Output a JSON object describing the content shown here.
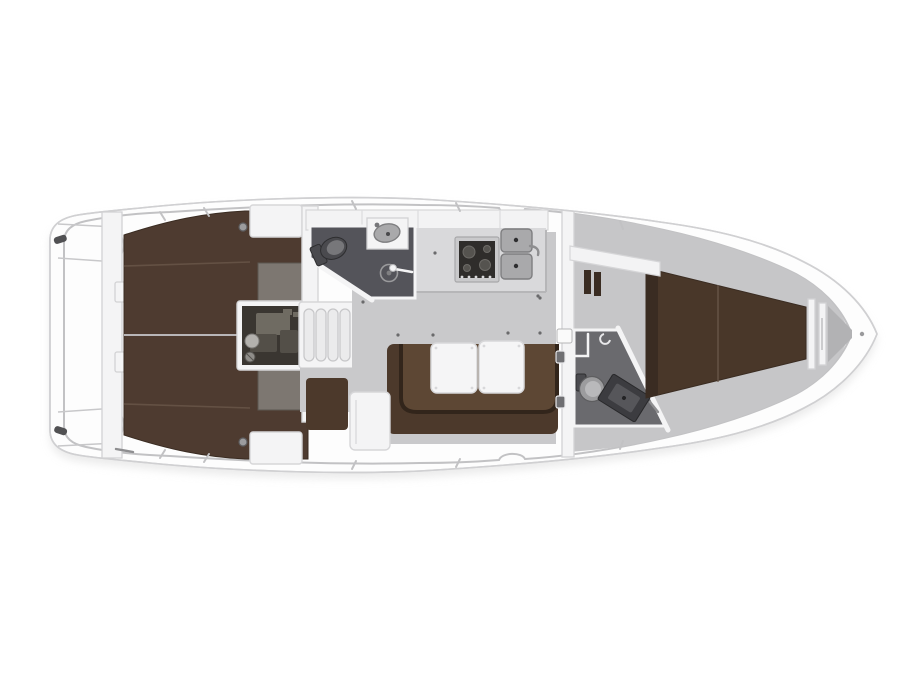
{
  "diagram": {
    "type": "boat-floor-plan",
    "subject": "sailing-yacht-interior-top-view",
    "orientation": "bow-right-stern-left",
    "background": "#ffffff"
  },
  "parts": {
    "stern_deck": "aft deck and transom lockers",
    "aft_bulkhead": "aft bulkhead panel",
    "port_aft_cabin": "port aft double berth",
    "starboard_aft_cabin": "starboard aft double berth",
    "engine_compartment": "engine compartment",
    "companionway_steps": "companionway steps",
    "aft_head": "aft bathroom with toilet, sink and shower",
    "galley": "galley with stove and double sink",
    "salon": "salon with U-settee and folding table",
    "nav_seat": "seat beside companionway",
    "forward_bulkhead": "forward cabin bulkhead with door",
    "forward_head": "forward bathroom with toilet and vanity",
    "forward_cabin": "forward V-berth cabin",
    "anchor_locker": "bow anchor locker",
    "bow": "bow tip"
  },
  "colors": {
    "hull": "#fdfdfd",
    "hullStroke": "#d0d0d2",
    "innerLine": "#c2c2c4",
    "deck": "#f4f4f5",
    "deckStroke": "#d6d6d8",
    "floor": "#c9c9cb",
    "floorFwd": "#c6c6c8",
    "anchorFloor": "#b2b2b4",
    "berthAft": "#4e3b30",
    "berthFwd": "#493729",
    "berthDark": "#3a2c22",
    "seam": "#6a574a",
    "setteeBack": "#4c392b",
    "setteeSeat": "#5d4734",
    "setteeEdge": "#32251b",
    "table": "#f5f5f6",
    "tableStroke": "#d8d8da",
    "counter": "#d9d9db",
    "counterEdge": "#b6b6b8",
    "locker": "#f3f3f4",
    "stoveFrame": "#c9c9cb",
    "stoveDark": "#2f2d2b",
    "burner": "#55534f",
    "sink": "#a9a9ab",
    "sinkStroke": "#7e7e80",
    "headFloorAft": "#54545a",
    "headFloorFwd": "#6a6a6e",
    "wall": "#f4f4f5",
    "wallStroke": "#d2d2d4",
    "fixture": "#9c9c9e",
    "fixtureDark": "#4a4a4e",
    "vanity": "#3c3c40",
    "vanityInner": "#56565a",
    "engineBg": "#3a3631",
    "engineLight": "#6f6b62",
    "engineMid": "#534f48",
    "panel": "#7d7771",
    "panelStroke": "#5c5751",
    "tabDark": "#6f6f72",
    "metal": "#8e8e90",
    "cleat": "#515153",
    "shadow": "#d6d6d6"
  }
}
